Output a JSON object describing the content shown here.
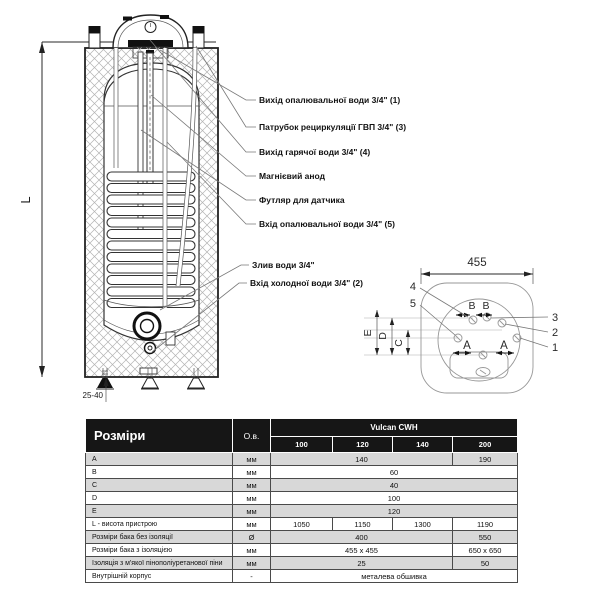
{
  "main_diagram": {
    "height_label": "L",
    "feet_adjust": "25-40",
    "callouts": [
      {
        "text": "Вихід опалювальної води 3/4\" (1)"
      },
      {
        "text": "Патрубок рециркуляції ГВП  3/4\" (3)"
      },
      {
        "text": "Вихід гарячої води 3/4\" (4)"
      },
      {
        "text": "Магнієвий анод"
      },
      {
        "text": "Футляр для датчика"
      },
      {
        "text": "Вхід опалювальної води 3/4\" (5)"
      },
      {
        "text": "Злив води 3/4\""
      },
      {
        "text": "Вхід холодної води 3/4\" (2)"
      }
    ]
  },
  "top_view": {
    "width_dim": "455",
    "letters": {
      "b1": "B",
      "b2": "B",
      "a1": "A",
      "a2": "A",
      "c": "C",
      "d": "D",
      "e": "E"
    },
    "numbers": {
      "n4": "4",
      "n5": "5",
      "n3": "3",
      "n2": "2",
      "n1": "1"
    }
  },
  "table": {
    "title": "Розміри",
    "unit_col": "О.в.",
    "brand": "Vulcan CWH",
    "models": [
      "100",
      "120",
      "140",
      "200"
    ],
    "rows": [
      {
        "label": "A",
        "unit": "мм",
        "v": [
          "140",
          "190"
        ]
      },
      {
        "label": "B",
        "unit": "мм",
        "v": [
          "60"
        ]
      },
      {
        "label": "C",
        "unit": "мм",
        "v": [
          "40"
        ]
      },
      {
        "label": "D",
        "unit": "мм",
        "v": [
          "100"
        ]
      },
      {
        "label": "E",
        "unit": "мм",
        "v": [
          "120"
        ]
      },
      {
        "label": "L - висота пристрою",
        "unit": "мм",
        "v": [
          "1050",
          "1150",
          "1300",
          "1190"
        ]
      },
      {
        "label": "Розміри бака без ізоляції",
        "unit": "Ø",
        "v": [
          "400",
          "550"
        ]
      },
      {
        "label": "Розміри бака з ізоляцією",
        "unit": "мм",
        "v": [
          "455 x 455",
          "650 x 650"
        ]
      },
      {
        "label": "Ізоляція з м'якої пінополіуретанової піни",
        "unit": "мм",
        "v": [
          "25",
          "50"
        ]
      },
      {
        "label": "Внутрішній корпус",
        "unit": "-",
        "v": [
          "металева обшивка"
        ]
      }
    ]
  }
}
